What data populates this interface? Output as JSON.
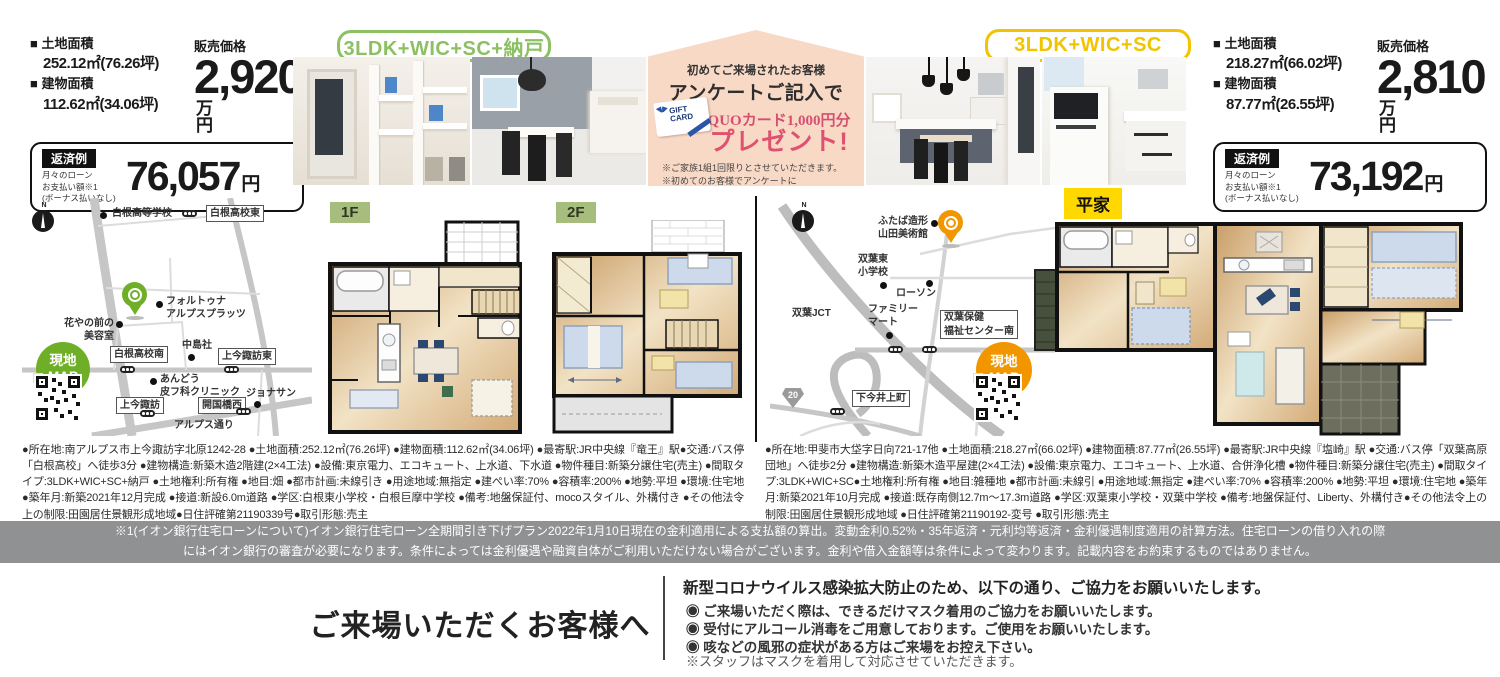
{
  "campaign": {
    "line1": "初めてご来場されたお客様",
    "line2": "アンケートご記入で",
    "quo_line": "QUOカード1,000円分",
    "present": "プレゼント!",
    "gift_card_text": "GIFT\nCARD",
    "note1": "※ご家族1組1回限りとさせていただきます。",
    "note2": "※初めてのお客様でアンケートに\n　ご記入をいただいた方が対象です。"
  },
  "property_left": {
    "plan_badge": "3LDK+WIC+SC+納戸",
    "land_label": "■ 土地面積",
    "land_value": "252.12㎡(76.26坪)",
    "building_label": "■ 建物面積",
    "building_value": "112.62㎡(34.06坪)",
    "price_label": "販売価格",
    "price_value": "2,920",
    "price_unit": "万円",
    "repayment_badge": "返済例",
    "repayment_notes": "月々のローン\nお支払い額※1\n(ボーナス払いなし)",
    "repayment_amount": "76,057",
    "repayment_unit": "円",
    "floor1_label": "1F",
    "floor2_label": "2F",
    "map": {
      "genchi": "現地\nMAP",
      "compass": "N",
      "pin_place": "フォルトゥナ\nアルプスプラッツ",
      "places": [
        "白根高等学校",
        "花やの前の\n美容室",
        "中島社",
        "あんどう\n皮フ科クリニック",
        "ジョナサン"
      ],
      "boxes": [
        "白根高校東",
        "白根高校南",
        "上今諏訪東",
        "上今諏訪",
        "開国橋西"
      ],
      "road_name": "アルプス通り"
    },
    "details": "●所在地:南アルプス市上今諏訪字北原1242-28 ●土地面積:252.12㎡(76.26坪) ●建物面積:112.62㎡(34.06坪) ●最寄駅:JR中央線『竜王』駅●交通:バス停「白根高校」へ徒歩3分 ●建物構造:新築木造2階建(2×4工法) ●設備:東京電力、エコキュート、上水道、下水道 ●物件種目:新築分譲住宅(売主) ●間取タイプ:3LDK+WIC+SC+納戸 ●土地権利:所有権 ●地目:畑 ●都市計画:未線引き ●用途地域:無指定 ●建ぺい率:70% ●容積率:200% ●地勢:平坦 ●環境:住宅地 ●築年月:新築2021年12月完成 ●接道:新設6.0m道路 ●学区:白根東小学校・白根巨摩中学校 ●備考:地盤保証付、mocoスタイル、外構付き ●その他法令上の制限:田園居住景観形成地域●日住評確第21190339号●取引形態:売主"
  },
  "property_right": {
    "plan_badge": "3LDK+WIC+SC",
    "land_label": "■ 土地面積",
    "land_value": "218.27㎡(66.02坪)",
    "building_label": "■ 建物面積",
    "building_value": "87.77㎡(26.55坪)",
    "price_label": "販売価格",
    "price_value": "2,810",
    "price_unit": "万円",
    "repayment_badge": "返済例",
    "repayment_notes": "月々のローン\nお支払い額※1\n(ボーナス払いなし)",
    "repayment_amount": "73,192",
    "repayment_unit": "円",
    "floor_label": "平家",
    "map": {
      "genchi": "現地\nMAP",
      "compass": "N",
      "pin_place": "ふたば造形\n山田美術館",
      "places": [
        "双葉東\n小学校",
        "ローソン",
        "双葉JCT",
        "ファミリー\nマート"
      ],
      "boxes": [
        "双葉保健\n福祉センター南",
        "下今井上町"
      ],
      "route_number": "20"
    },
    "details": "●所在地:甲斐市大垈字日向721-17他 ●土地面積:218.27㎡(66.02坪) ●建物面積:87.77㎡(26.55坪) ●最寄駅:JR中央線『塩崎』駅 ●交通:バス停「双葉高原団地」へ徒歩2分 ●建物構造:新築木造平屋建(2×4工法) ●設備:東京電力、エコキュート、上水道、合併浄化槽 ●物件種目:新築分譲住宅(売主) ●間取タイプ:3LDK+WIC+SC●土地権利:所有権 ●地目:雑種地 ●都市計画:未線引 ●用途地域:無指定 ●建ぺい率:70% ●容積率:200% ●地勢:平坦 ●環境:住宅地 ●築年月:新築2021年10月完成 ●接道:既存南側12.7m〜17.3m道路 ●学区:双葉東小学校・双葉中学校 ●備考:地盤保証付、Liberty、外構付き●その他法令上の制限:田園居住景観形成地域 ●日住評確第21190192-変号 ●取引形態:売主"
  },
  "loan_note": "※1(イオン銀行住宅ローンについて)イオン銀行住宅ローン全期間引き下げプラン2022年1月10日現在の金利適用による支払額の算出。変動金利0.52%・35年返済・元利均等返済・金利優遇制度適用の計算方法。住宅ローンの借り入れの際\nにはイオン銀行の審査が必要になります。条件によっては金利優遇や融資自体がご利用いただけない場合がございます。金利や借入金額等は条件によって変わります。記載内容をお約束するものではありません。",
  "visitor": {
    "title": "ご来場いただくお客様へ",
    "heading": "新型コロナウイルス感染拡大防止のため、以下の通り、ご協力をお願いいたします。",
    "bullets": [
      "◉ ご来場いただく際は、できるだけマスク着用のご協力をお願いいたします。",
      "◉ 受付にアルコール消毒をご用意しております。ご使用をお願いいたします。",
      "◉ 咳などの風邪の症状がある方はご来場をお控え下さい。"
    ],
    "note": "※スタッフはマスクを着用して対応させていただきます。"
  }
}
